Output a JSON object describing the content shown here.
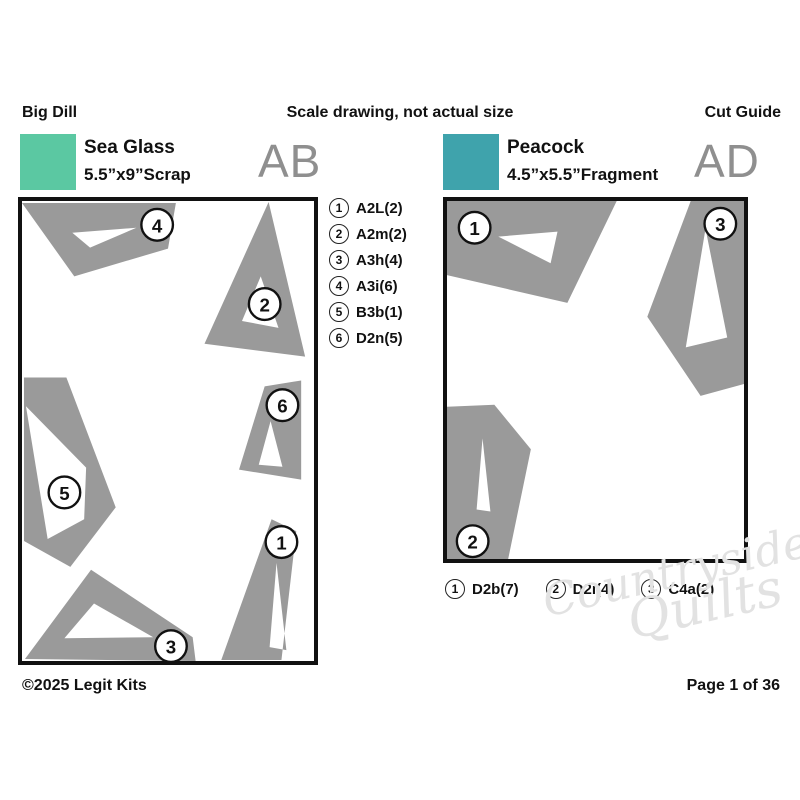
{
  "page": {
    "kit_name": "Big Dill",
    "scale_note": "Scale drawing, not actual size",
    "guide_label": "Cut Guide",
    "copyright": "©2025 Legit Kits",
    "page_number": "Page 1 of 36",
    "watermark_line1": "Countryside",
    "watermark_line2": "Quilts"
  },
  "colors": {
    "shape_gray": "#9a9a9a",
    "panel_code_gray": "#8f8f8f",
    "border_black": "#111111"
  },
  "panels": [
    {
      "code": "AB",
      "fabric_name": "Sea Glass",
      "fabric_size": "5.5”x9”Scrap",
      "swatch_color": "#5bc8a2",
      "viewbox": [
        296,
        464
      ],
      "legend": [
        {
          "num": "1",
          "label": "A2L(2)"
        },
        {
          "num": "2",
          "label": "A2m(2)"
        },
        {
          "num": "3",
          "label": "A3h(4)"
        },
        {
          "num": "4",
          "label": "A3i(6)"
        },
        {
          "num": "5",
          "label": "B3b(1)"
        },
        {
          "num": "6",
          "label": "D2n(5)"
        }
      ],
      "shapes": [
        {
          "num": "4",
          "outer": [
            [
              0,
              2
            ],
            [
              156,
              2
            ],
            [
              148,
              48
            ],
            [
              53,
              76
            ]
          ],
          "hole": [
            [
              51,
              32
            ],
            [
              116,
              27
            ],
            [
              69,
              47
            ]
          ],
          "marker": [
            137,
            24
          ]
        },
        {
          "num": "2",
          "outer": [
            [
              250,
              1
            ],
            [
              185,
              144
            ],
            [
              287,
              157
            ]
          ],
          "hole": [
            [
              242,
              76
            ],
            [
              223,
              121
            ],
            [
              260,
              128
            ]
          ],
          "marker": [
            246,
            104
          ]
        },
        {
          "num": "6",
          "outer": [
            [
              246,
              187
            ],
            [
              283,
              181
            ],
            [
              283,
              281
            ],
            [
              220,
              271
            ]
          ],
          "hole": [
            [
              252,
              222
            ],
            [
              240,
              266
            ],
            [
              264,
              268
            ]
          ],
          "marker": [
            264,
            206
          ]
        },
        {
          "num": "5",
          "outer": [
            [
              2,
              178
            ],
            [
              45,
              178
            ],
            [
              95,
              309
            ],
            [
              49,
              369
            ],
            [
              2,
              343
            ]
          ],
          "hole": [
            [
              4,
              207
            ],
            [
              65,
              269
            ],
            [
              63,
              321
            ],
            [
              26,
              341
            ]
          ],
          "marker": [
            43,
            294
          ]
        },
        {
          "num": "1",
          "outer": [
            [
              253,
              321
            ],
            [
              278,
              333
            ],
            [
              263,
              463
            ],
            [
              202,
              463
            ]
          ],
          "hole": [
            [
              258,
              365
            ],
            [
              251,
              450
            ],
            [
              268,
              453
            ]
          ],
          "marker": [
            263,
            344
          ]
        },
        {
          "num": "3",
          "outer": [
            [
              70,
              372
            ],
            [
              173,
              440
            ],
            [
              176,
              464
            ],
            [
              3,
              462
            ]
          ],
          "hole": [
            [
              73,
              406
            ],
            [
              43,
              441
            ],
            [
              133,
              440
            ]
          ],
          "marker": [
            151,
            449
          ]
        }
      ]
    },
    {
      "code": "AD",
      "fabric_name": "Peacock",
      "fabric_size": "4.5”x5.5”Fragment",
      "swatch_color": "#3fa3ac",
      "viewbox": [
        301,
        362
      ],
      "legend": [
        {
          "num": "1",
          "label": "D2b(7)"
        },
        {
          "num": "2",
          "label": "D2i(4)"
        },
        {
          "num": "3",
          "label": "C4a(2)"
        }
      ],
      "shapes": [
        {
          "num": "1",
          "outer": [
            [
              0,
              0
            ],
            [
              172,
              0
            ],
            [
              122,
              103
            ],
            [
              0,
              75
            ]
          ],
          "hole": [
            [
              52,
              36
            ],
            [
              112,
              31
            ],
            [
              105,
              63
            ]
          ],
          "marker": [
            28,
            27
          ]
        },
        {
          "num": "3",
          "outer": [
            [
              247,
              0
            ],
            [
              301,
              0
            ],
            [
              301,
              185
            ],
            [
              257,
              197
            ],
            [
              203,
              117
            ]
          ],
          "hole": [
            [
              262,
              28
            ],
            [
              284,
              138
            ],
            [
              242,
              148
            ]
          ],
          "marker": [
            277,
            23
          ]
        },
        {
          "num": "2",
          "outer": [
            [
              0,
              208
            ],
            [
              48,
              206
            ],
            [
              85,
              251
            ],
            [
              62,
              362
            ],
            [
              0,
              362
            ]
          ],
          "hole": [
            [
              36,
              240
            ],
            [
              30,
              312
            ],
            [
              44,
              314
            ]
          ],
          "marker": [
            26,
            344
          ]
        }
      ]
    }
  ]
}
